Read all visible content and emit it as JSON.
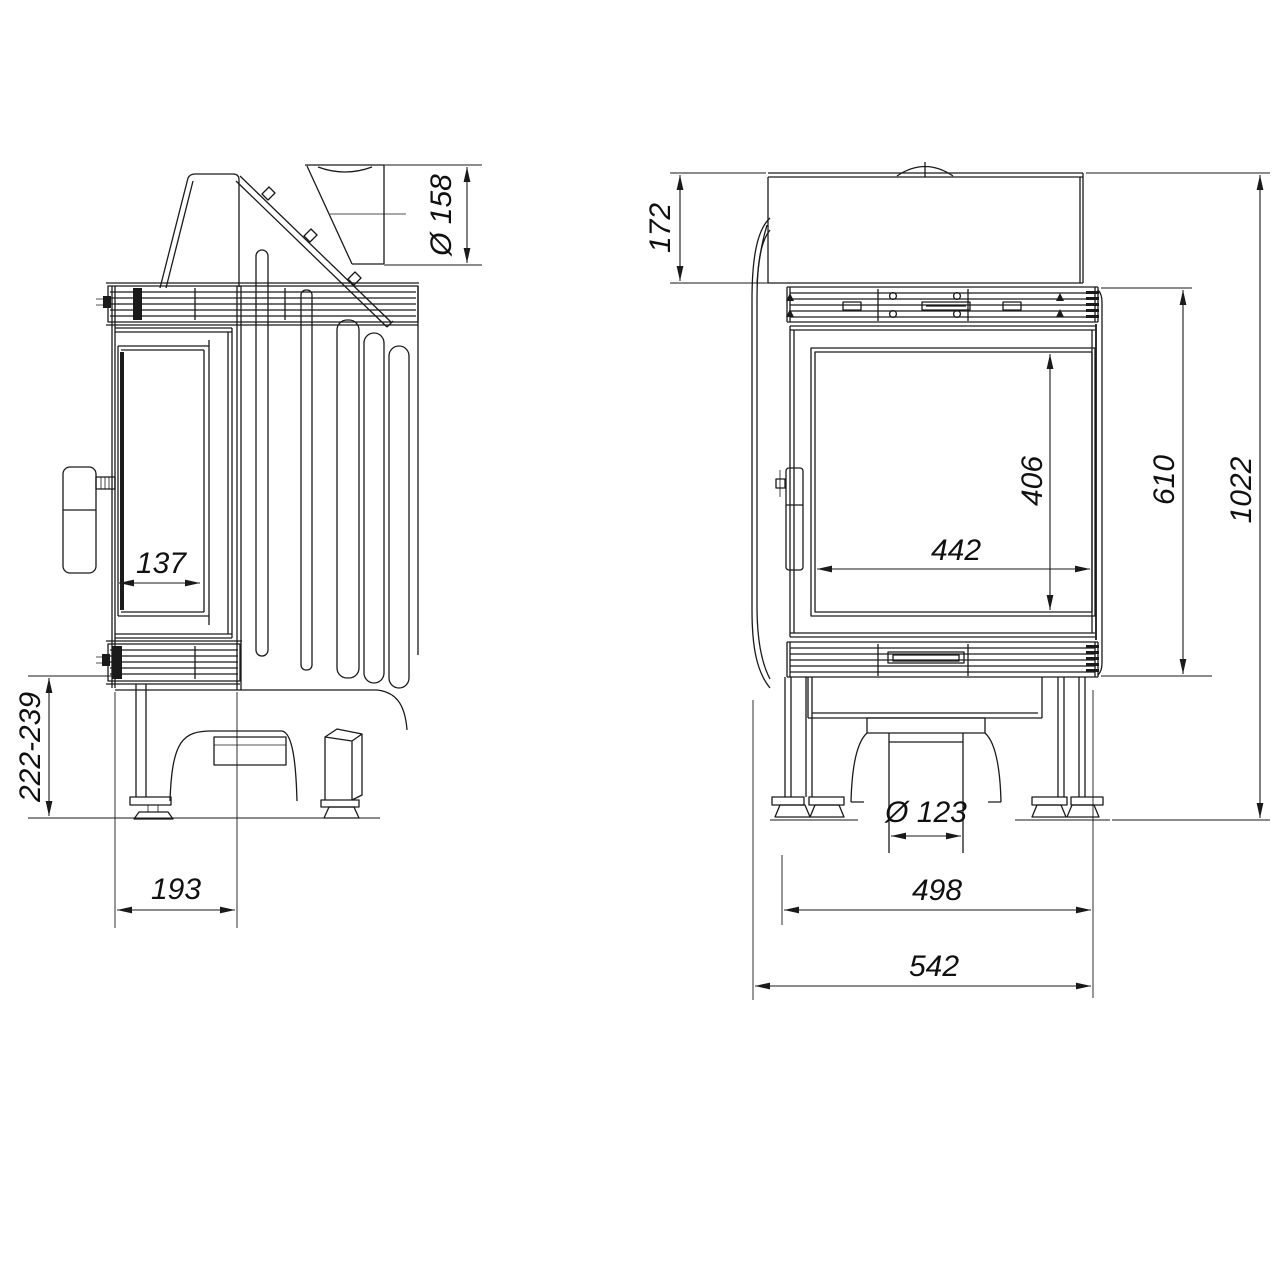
{
  "drawing": {
    "background": "#ffffff",
    "line_color": "#1a1a1a",
    "views": {
      "side": {
        "dimensions": {
          "flue_diameter": "Ø 158",
          "glass_depth": "137",
          "base_clearance": "222-239",
          "front_section_depth": "193"
        }
      },
      "front": {
        "dimensions": {
          "top_section_height": "172",
          "glass_height": "406",
          "firebox_front_height": "610",
          "overall_height": "1022",
          "glass_width": "442",
          "air_inlet_diameter": "Ø 123",
          "body_width": "498",
          "overall_width": "542"
        }
      }
    }
  }
}
